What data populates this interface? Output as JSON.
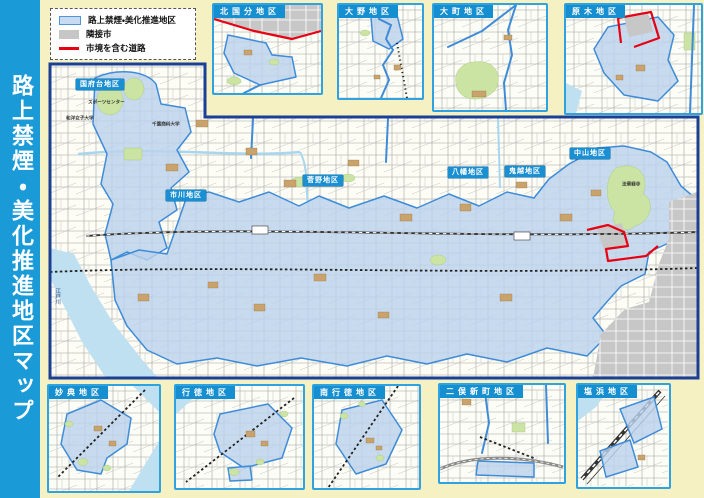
{
  "sidebar": {
    "title": "路上禁煙・美化推進地区マップ"
  },
  "legend": {
    "items": [
      {
        "label": "路上禁煙・美化推進地区",
        "swatch": "district-fill"
      },
      {
        "label": "隣接市",
        "swatch": "neighbor-city-fill"
      },
      {
        "label": "市境を含む道路",
        "swatch": "city-border-road-line"
      }
    ]
  },
  "main_map": {
    "districts": [
      {
        "label": "国府台地区"
      },
      {
        "label": "市川地区"
      },
      {
        "label": "菅野地区"
      },
      {
        "label": "八幡地区"
      },
      {
        "label": "鬼越地区"
      },
      {
        "label": "中山地区"
      }
    ],
    "annotations": [
      {
        "label": "スポーツセンター"
      },
      {
        "label": "千葉商科大学"
      },
      {
        "label": "和洋女子大学"
      },
      {
        "label": "法華経寺"
      },
      {
        "label": "江戸川"
      }
    ]
  },
  "insets": {
    "top": [
      {
        "label": "北国分地区"
      },
      {
        "label": "大野地区"
      },
      {
        "label": "大町地区"
      },
      {
        "label": "原木地区"
      }
    ],
    "bottom": [
      {
        "label": "妙典地区"
      },
      {
        "label": "行徳地区"
      },
      {
        "label": "南行徳地区"
      },
      {
        "label": "二俣新町地区"
      },
      {
        "label": "塩浜地区"
      }
    ]
  },
  "colors": {
    "accent_blue": "#1B9AD8",
    "inset_border_blue": "#2EA3E0",
    "label_box_blue": "#168FD0",
    "district_fill": "#C9DBF2",
    "district_stroke": "#3E8CD8",
    "neighbor_city_gray": "#C6C6C6",
    "city_border_road_red": "#E60012",
    "background_cream": "#F6F1C3",
    "map_frame_navy": "#1A3F94",
    "park_green": "#CBE4A4",
    "water_blue": "#BFE0F1"
  }
}
